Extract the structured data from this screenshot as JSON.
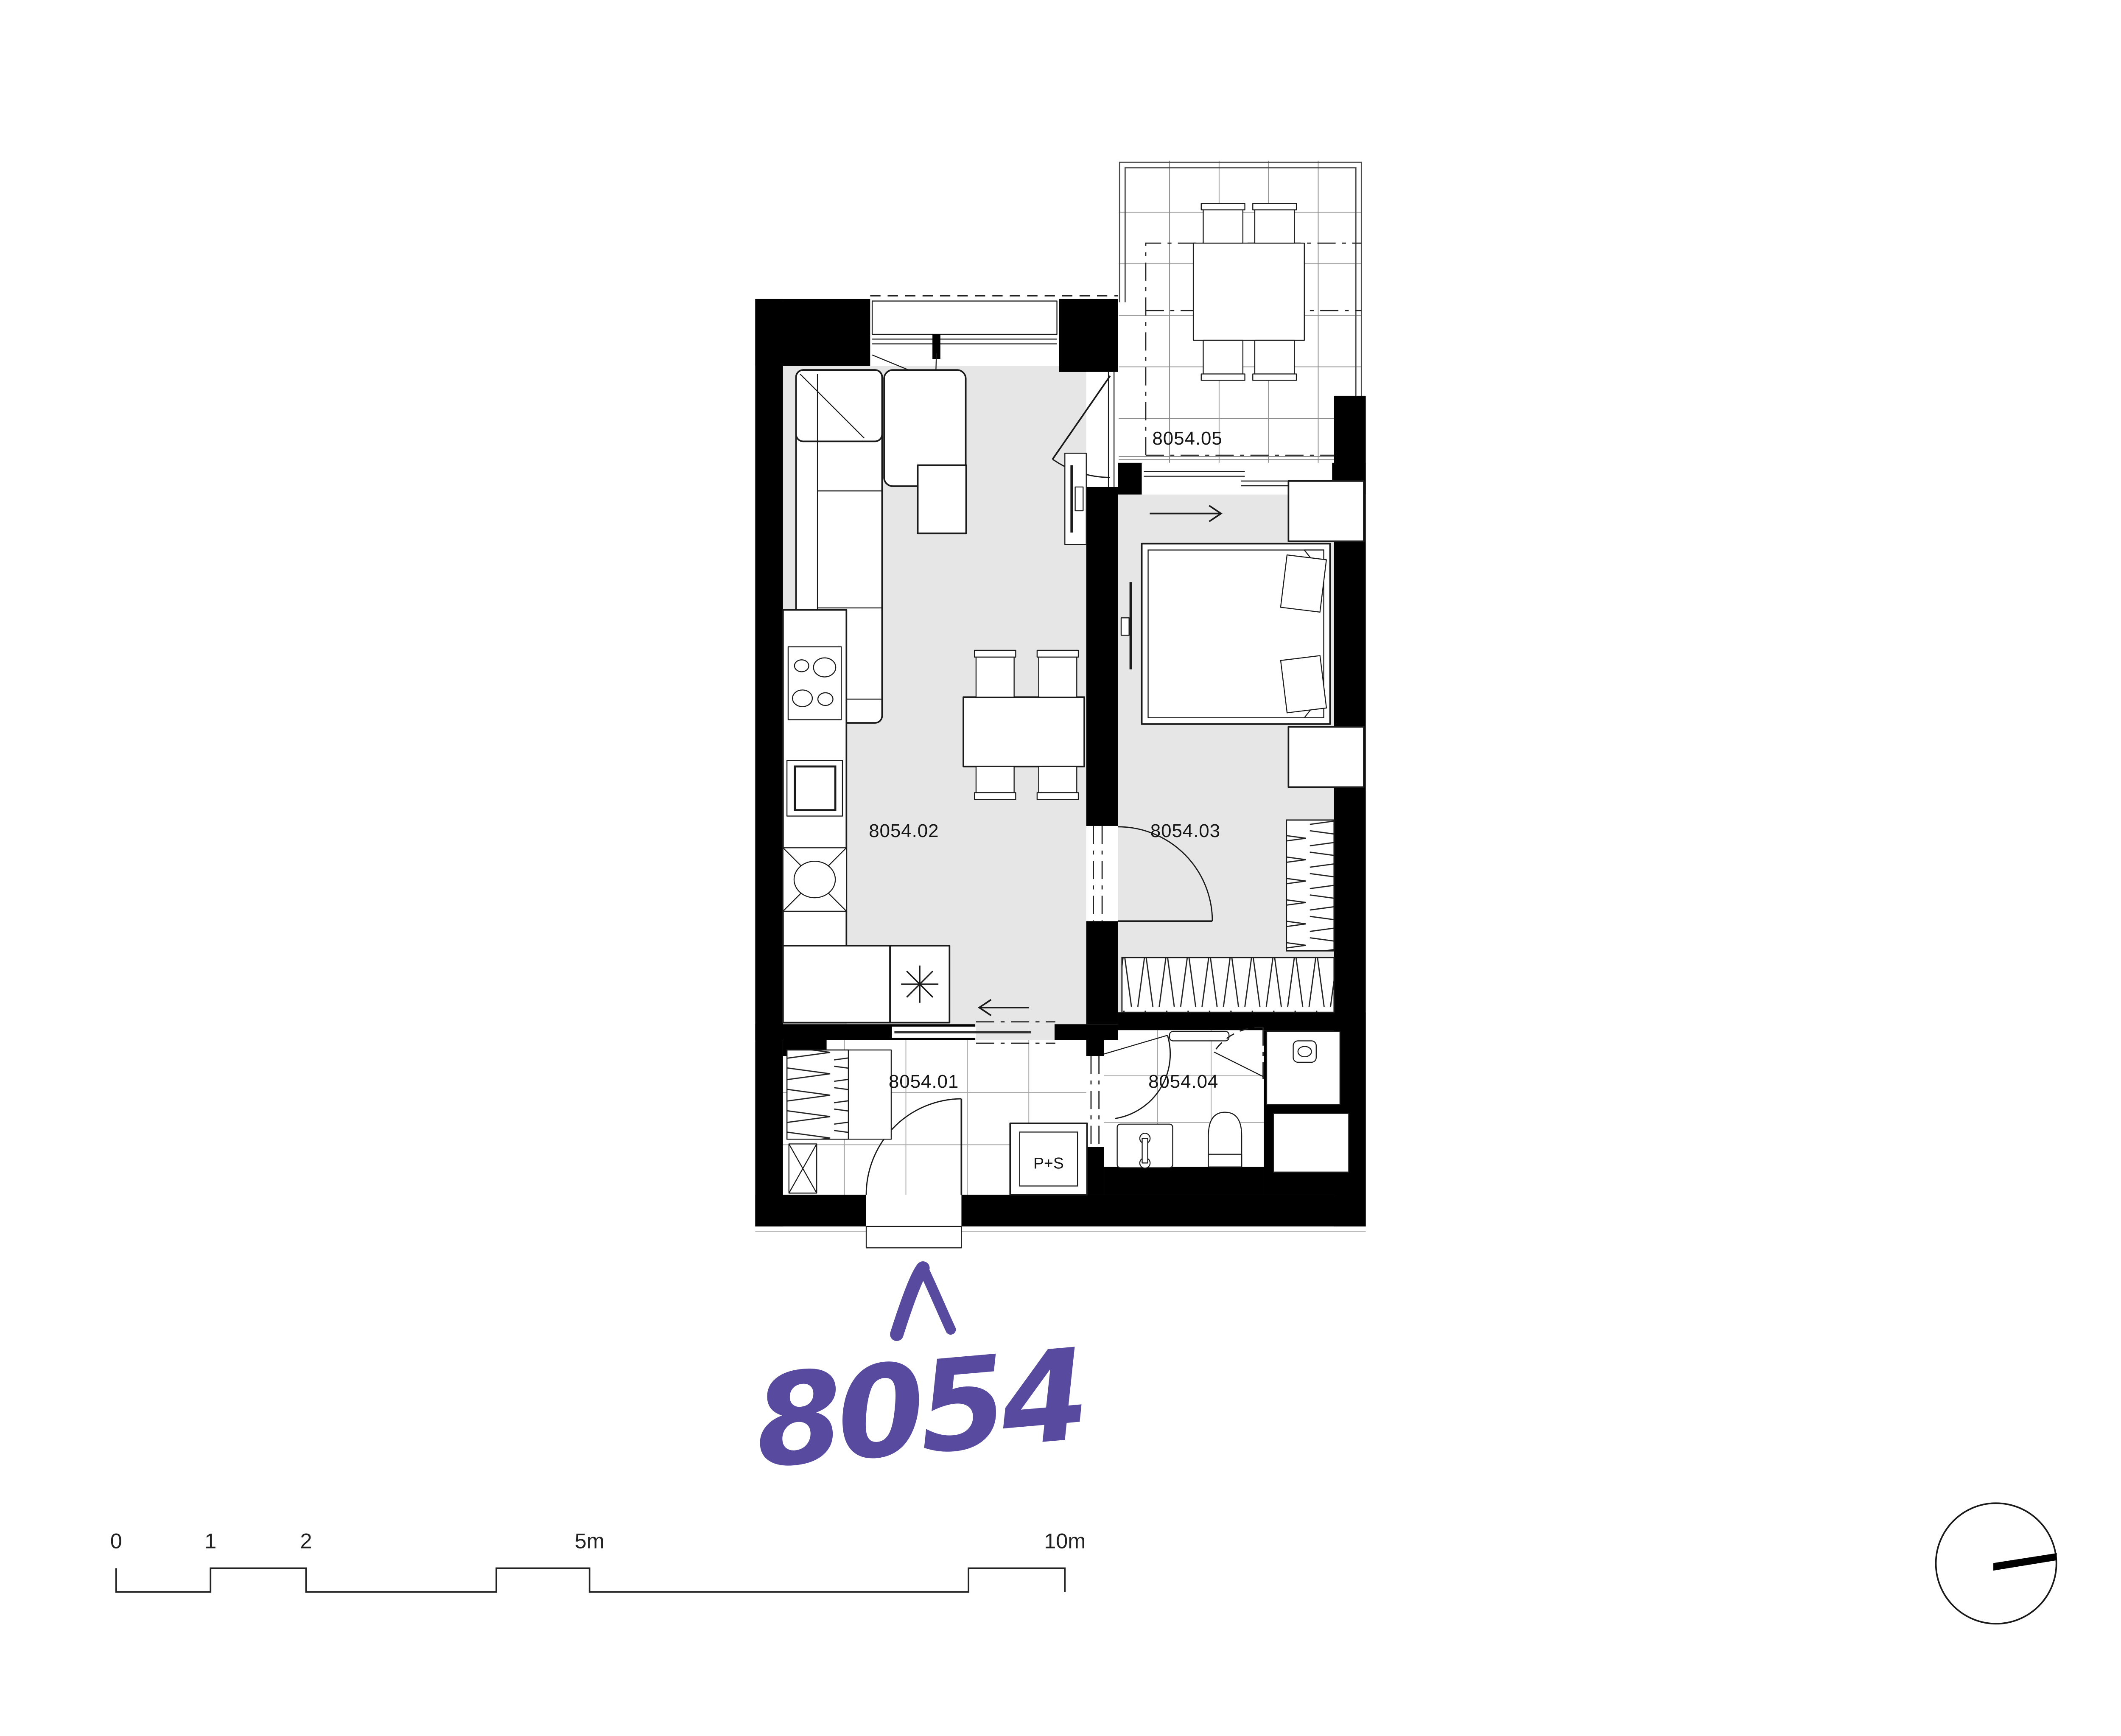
{
  "page": {
    "background": "#ffffff"
  },
  "plan": {
    "unit_number": "8054",
    "rooms": [
      {
        "code": "8054.01",
        "type": "hallway"
      },
      {
        "code": "8054.02",
        "type": "living-room-with-kitchen"
      },
      {
        "code": "8054.03",
        "type": "bedroom"
      },
      {
        "code": "8054.04",
        "type": "bathroom"
      },
      {
        "code": "8054.05",
        "type": "balcony"
      }
    ],
    "shaft_label": "P+S",
    "colors": {
      "wall": "#000000",
      "floor_gray": "#e6e6e7",
      "accent_purple": "#584a9e",
      "line": "#1a1a1a",
      "grid": "#a6a6a6"
    },
    "icons": [
      "up-chevron-icon",
      "north-indicator-icon",
      "snowflake-icon",
      "washing-machine-icon",
      "slide-left-arrow-icon",
      "slide-right-arrow-icon"
    ]
  },
  "scale_bar": {
    "tick_labels": [
      "0",
      "1",
      "2",
      "5m",
      "10m"
    ]
  }
}
